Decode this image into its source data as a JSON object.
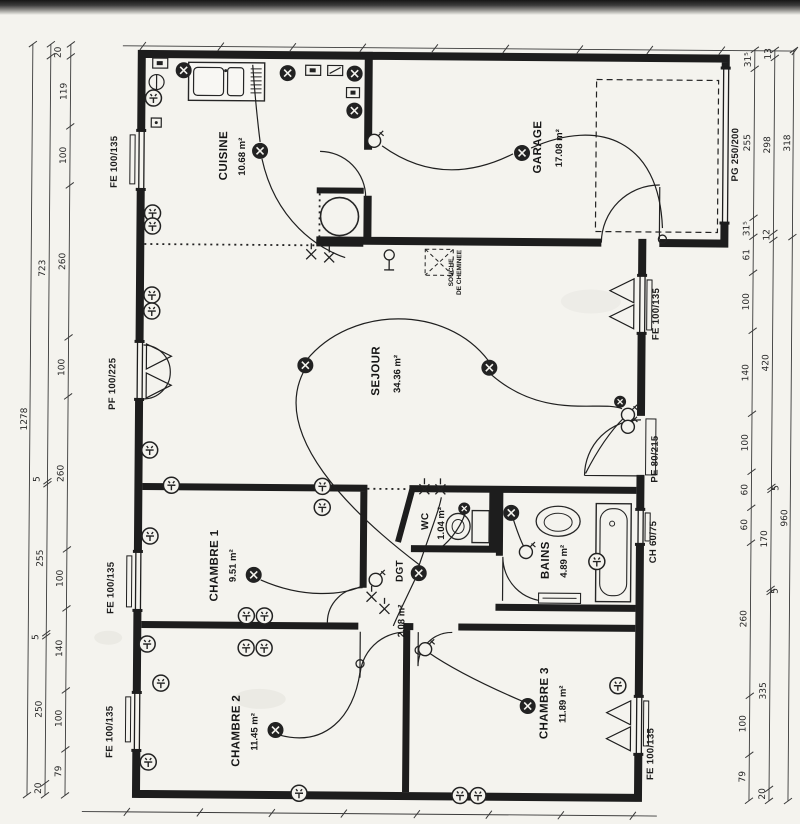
{
  "plan": {
    "rooms": [
      {
        "id": "cuisine",
        "name": "CUISINE",
        "area": "10.68 m²"
      },
      {
        "id": "garage",
        "name": "GARAGE",
        "area": "17.08 m²"
      },
      {
        "id": "sejour",
        "name": "SEJOUR",
        "area": "34.36 m²"
      },
      {
        "id": "wc",
        "name": "WC",
        "area": "1.04 m²"
      },
      {
        "id": "bains",
        "name": "BAINS",
        "area": "4.89 m²"
      },
      {
        "id": "dgt",
        "name": "DGT",
        "area": "2.08 m²"
      },
      {
        "id": "chambre1",
        "name": "CHAMBRE 1",
        "area": "9.51 m²"
      },
      {
        "id": "chambre2",
        "name": "CHAMBRE 2",
        "area": "11.45 m²"
      },
      {
        "id": "chambre3",
        "name": "CHAMBRE 3",
        "area": "11.89 m²"
      }
    ],
    "chimney": {
      "line1": "SOUCHE",
      "line2": "DE CHEMINEE"
    },
    "openings": {
      "left": [
        "FE 100/135",
        "PF 100/225",
        "FE 100/135",
        "FE 100/135"
      ],
      "right": [
        "FE 100/135",
        "PE 80/215",
        "CH 60/75",
        "FE 100/135"
      ],
      "garage_door": "PG 250/200"
    },
    "dimensions": {
      "left": {
        "total": "1278",
        "outer": [
          "723",
          "5",
          "255",
          "5",
          "250",
          "20"
        ],
        "inner": [
          "20",
          "119",
          "100",
          "260",
          "100",
          "260",
          "100",
          "140",
          "100",
          "79"
        ]
      },
      "right": {
        "inner": [
          "31⁵",
          "255",
          "31⁵",
          "61",
          "100",
          "140",
          "100",
          "60",
          "60",
          "260",
          "100",
          "79"
        ],
        "middle": [
          "13",
          "298",
          "12",
          "420",
          "5",
          "170",
          "5",
          "335",
          "20"
        ],
        "outer": [
          "318",
          "960"
        ]
      }
    }
  }
}
